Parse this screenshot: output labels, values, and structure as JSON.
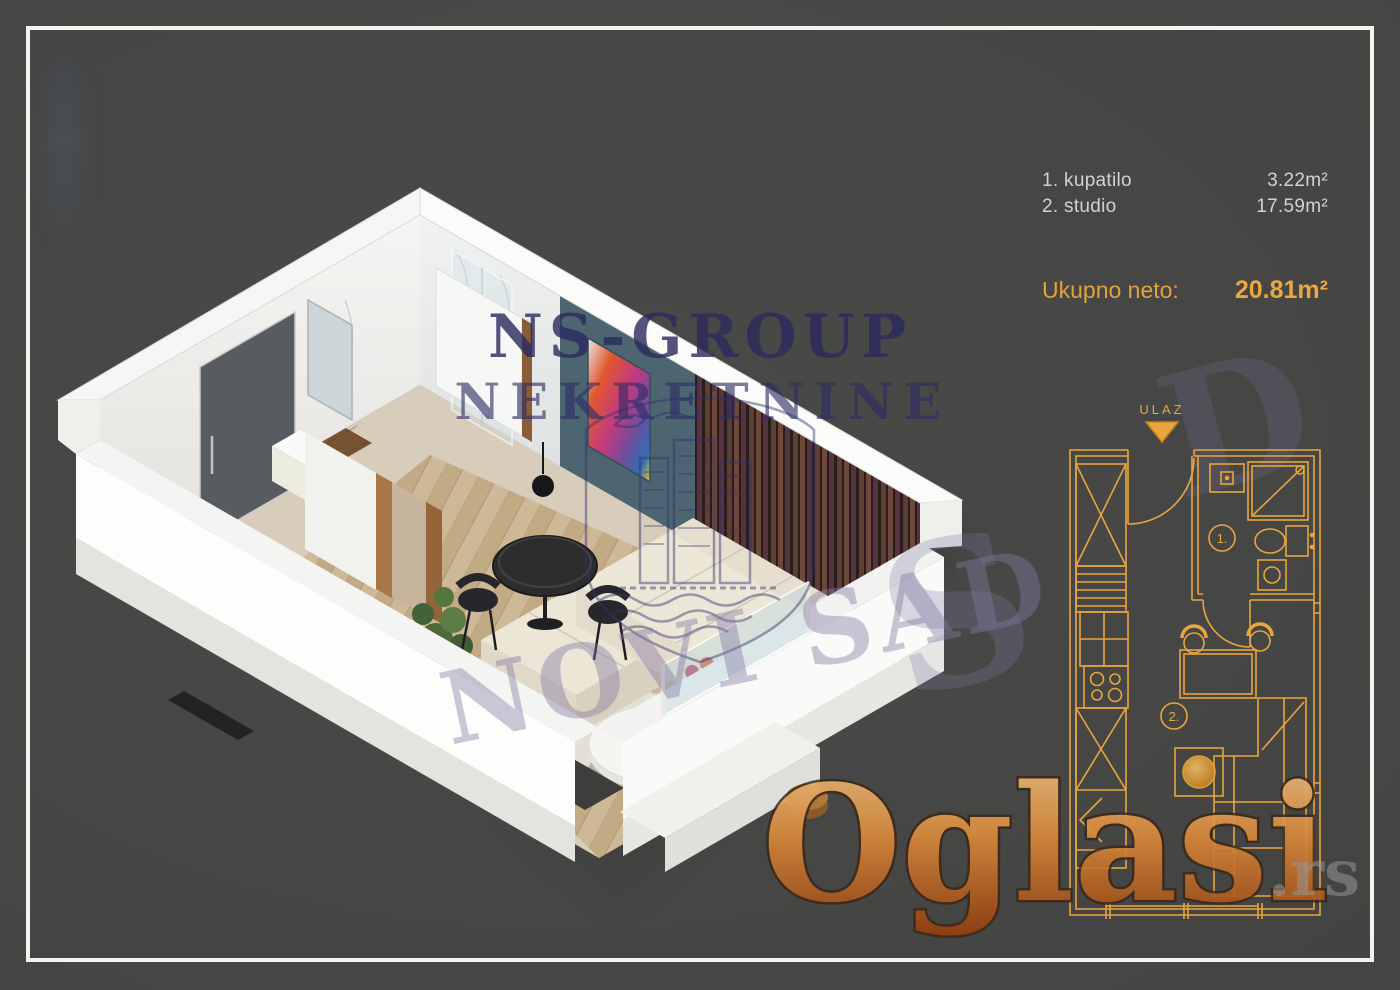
{
  "area_table": {
    "rows": [
      {
        "label": "1. kupatilo",
        "value": "3.22m²"
      },
      {
        "label": "2. studio",
        "value": "17.59m²"
      }
    ],
    "total_label": "Ukupno neto:",
    "total_value": "20.81m²",
    "text_color": "#d2d2d2",
    "accent_color": "#e8a63d"
  },
  "floor_plan": {
    "entrance_label": "ULAZ",
    "room_labels": [
      "1.",
      "2."
    ],
    "line_color": "#e8a63d"
  },
  "watermarks": {
    "agency_line1": "NS-GROUP",
    "agency_line2": "NEKRETNINE",
    "agency_color": "#2b2a5e",
    "city_text": "NOVI SAD",
    "city_fragment_s": "S",
    "city_fragment_d": "D",
    "city_color": "#7d76a3",
    "portal_text": "Oglasi",
    "portal_suffix": ".rs",
    "portal_gradient_top": "#ecc489",
    "portal_gradient_bottom": "#8f3c0e"
  },
  "render_palette": {
    "wall_white": "#f4f3f1",
    "teal_wall": "#4d6570",
    "slat_wall_brown": "#5c3e33",
    "entry_door_gray": "#585c60",
    "sofa_cream": "#ece6d7",
    "parquet_tan": "#cdb897"
  }
}
